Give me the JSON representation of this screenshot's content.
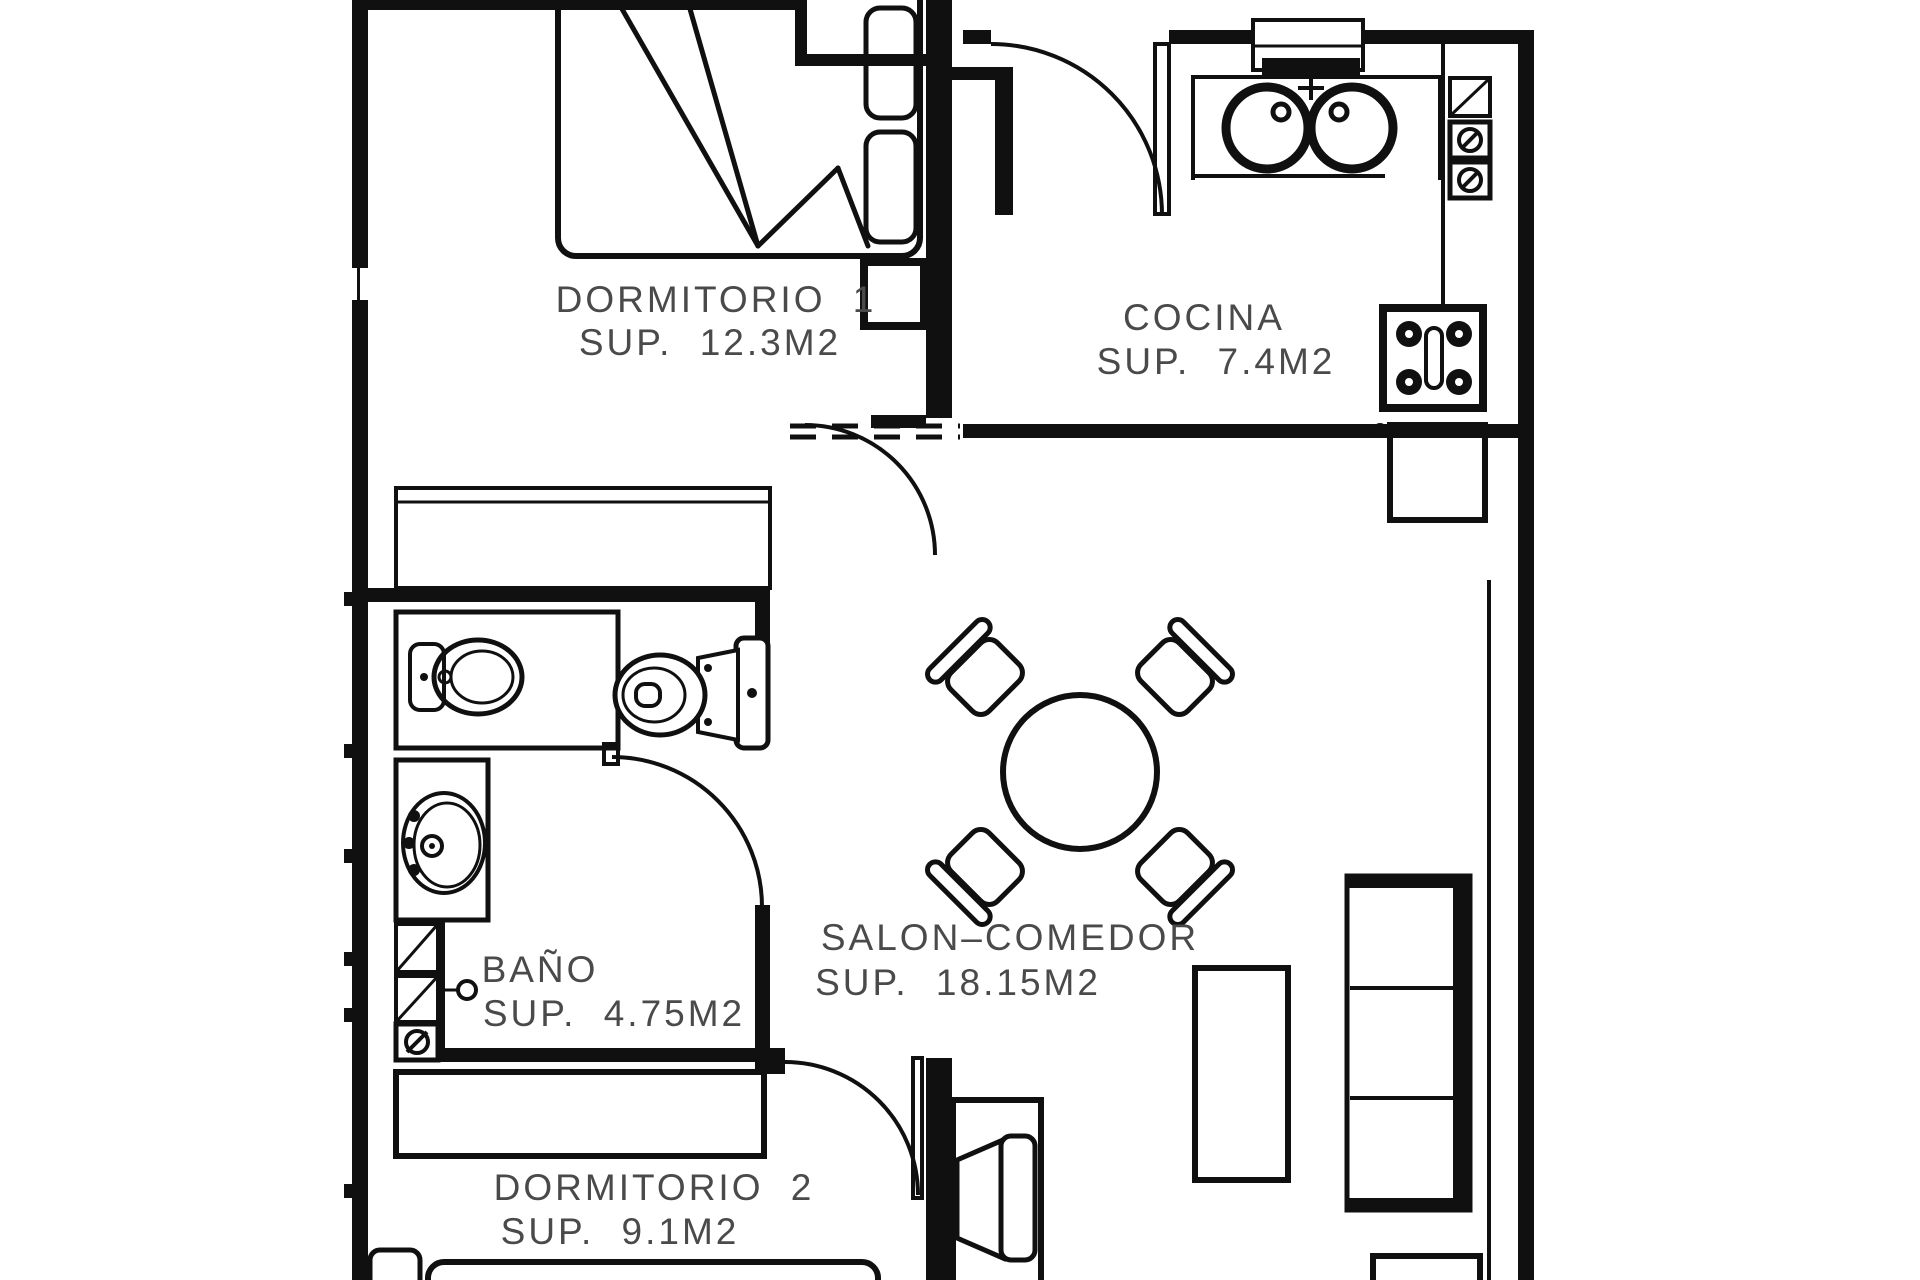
{
  "page": {
    "background": "#ffffff"
  },
  "plan": {
    "wall_color": "#101010",
    "label_color": "#4a4a4a",
    "rooms": [
      {
        "name": "DORMITORIO 1",
        "area": "SUP. 12.3M2"
      },
      {
        "name": "COCINA",
        "area": "SUP. 7.4M2"
      },
      {
        "name": "BAÑO",
        "area": "SUP. 4.75M2"
      },
      {
        "name": "SALON–COMEDOR",
        "area": "SUP. 18.15M2"
      },
      {
        "name": "DORMITORIO 2",
        "area": "SUP. 9.1M2"
      }
    ],
    "fixtures": [
      "double-bed",
      "pillows",
      "nightstand",
      "wardrobe-dormitorio-1",
      "kitchen-window",
      "kitchen-faucet",
      "double-sink",
      "kitchen-counter",
      "counter-appliances",
      "hob-4-burners",
      "kitchen-cabinet",
      "bidet",
      "toilet",
      "washbasin",
      "shower-column",
      "dining-table",
      "four-chairs",
      "sofa",
      "coffee-table",
      "tv",
      "tv-stand",
      "side-table",
      "wardrobe-dormitorio-2",
      "bed-dormitorio-2",
      "door-arcs"
    ]
  }
}
